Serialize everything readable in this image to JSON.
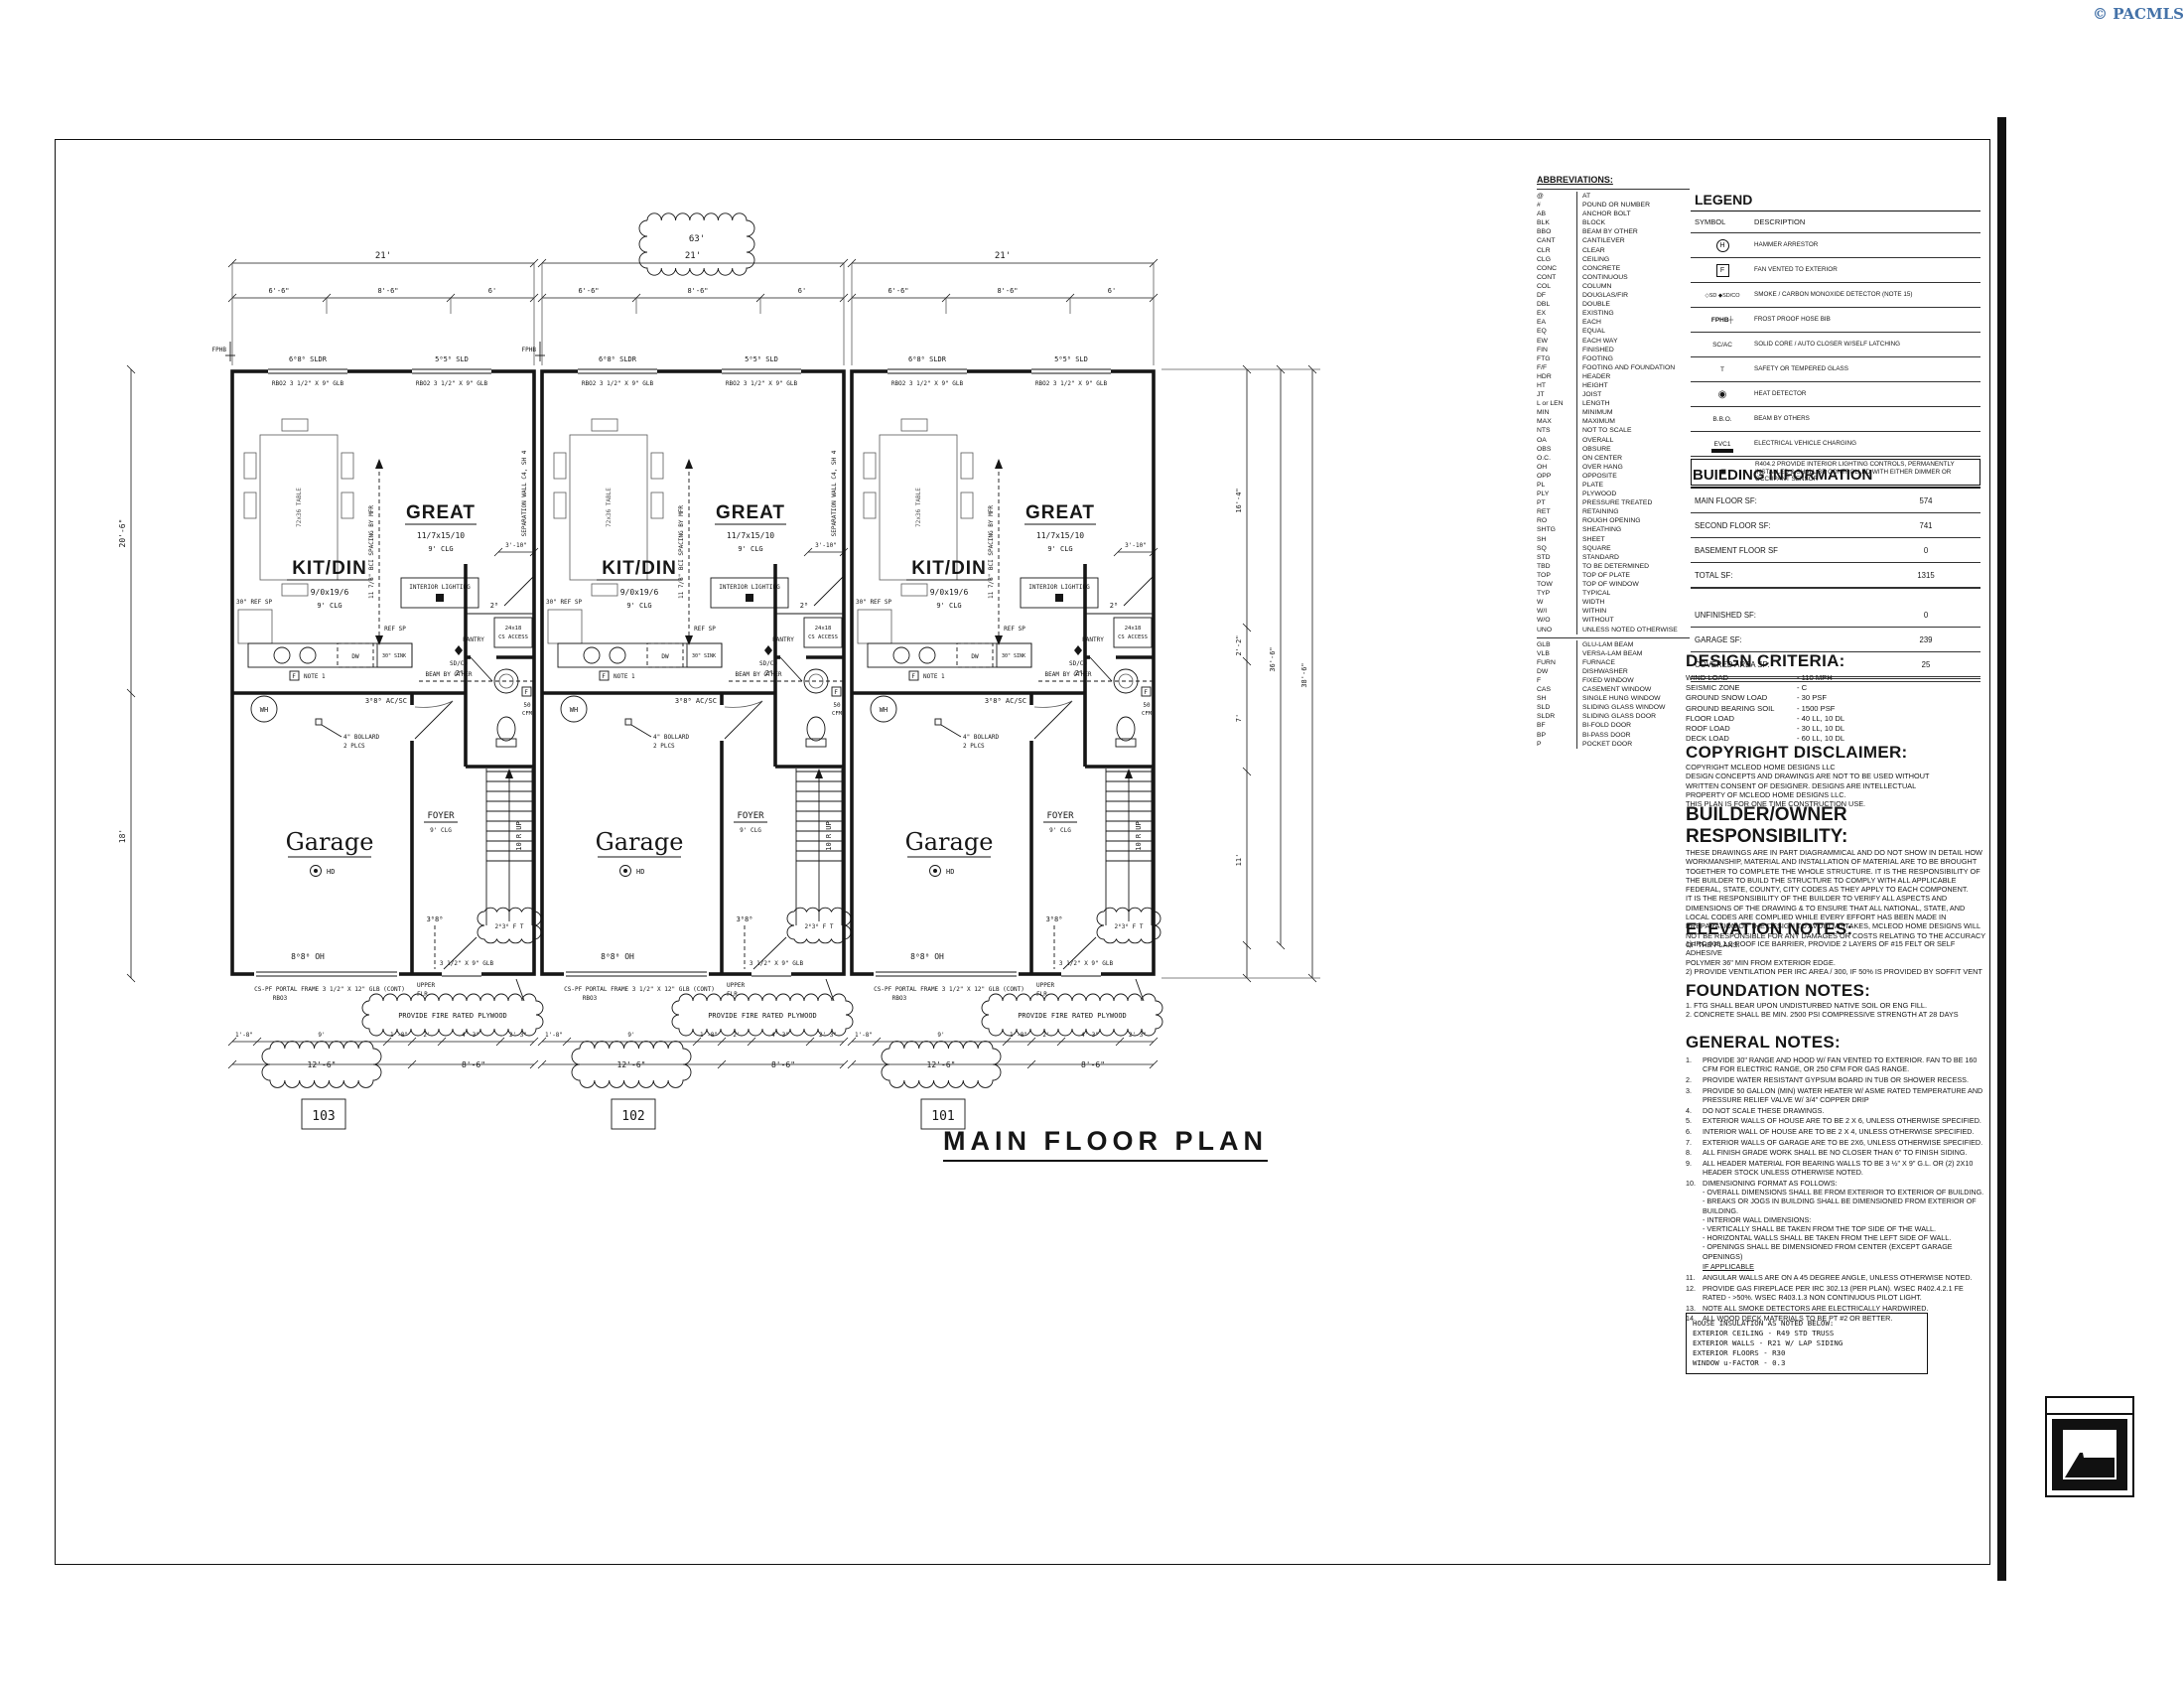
{
  "page": {
    "copyright": "© PACMLS",
    "title": "MAIN FLOOR PLAN"
  },
  "abbreviations": {
    "title": "ABBREVIATIONS:",
    "group1": [
      {
        "a": "@",
        "m": "AT"
      },
      {
        "a": "#",
        "m": "POUND OR NUMBER"
      },
      {
        "a": "AB",
        "m": "ANCHOR BOLT"
      },
      {
        "a": "BLK",
        "m": "BLOCK"
      },
      {
        "a": "BBO",
        "m": "BEAM BY OTHER"
      },
      {
        "a": "CANT",
        "m": "CANTILEVER"
      },
      {
        "a": "CLR",
        "m": "CLEAR"
      },
      {
        "a": "CLG",
        "m": "CEILING"
      },
      {
        "a": "CONC",
        "m": "CONCRETE"
      },
      {
        "a": "CONT",
        "m": "CONTINUOUS"
      },
      {
        "a": "COL",
        "m": "COLUMN"
      },
      {
        "a": "DF",
        "m": "DOUGLAS/FIR"
      },
      {
        "a": "DBL",
        "m": "DOUBLE"
      },
      {
        "a": "EX",
        "m": "EXISTING"
      },
      {
        "a": "EA",
        "m": "EACH"
      },
      {
        "a": "EQ",
        "m": "EQUAL"
      },
      {
        "a": "EW",
        "m": "EACH WAY"
      },
      {
        "a": "FIN",
        "m": "FINISHED"
      },
      {
        "a": "FTG",
        "m": "FOOTING"
      },
      {
        "a": "F/F",
        "m": "FOOTING AND FOUNDATION"
      },
      {
        "a": "HDR",
        "m": "HEADER"
      },
      {
        "a": "HT",
        "m": "HEIGHT"
      },
      {
        "a": "JT",
        "m": "JOIST"
      },
      {
        "a": "L or LEN",
        "m": "LENGTH"
      },
      {
        "a": "MIN",
        "m": "MINIMUM"
      },
      {
        "a": "MAX",
        "m": "MAXIMUM"
      },
      {
        "a": "NTS",
        "m": "NOT TO SCALE"
      },
      {
        "a": "OA",
        "m": "OVERALL"
      },
      {
        "a": "OBS",
        "m": "OBSURE"
      },
      {
        "a": "O.C.",
        "m": "ON CENTER"
      },
      {
        "a": "OH",
        "m": "OVER HANG"
      },
      {
        "a": "OPP",
        "m": "OPPOSITE"
      },
      {
        "a": "PL",
        "m": "PLATE"
      },
      {
        "a": "PLY",
        "m": "PLYWOOD"
      },
      {
        "a": "PT",
        "m": "PRESSURE TREATED"
      },
      {
        "a": "RET",
        "m": "RETAINING"
      },
      {
        "a": "RO",
        "m": "ROUGH OPENING"
      },
      {
        "a": "SHTG",
        "m": "SHEATHING"
      },
      {
        "a": "SH",
        "m": "SHEET"
      },
      {
        "a": "SQ",
        "m": "SQUARE"
      },
      {
        "a": "STD",
        "m": "STANDARD"
      },
      {
        "a": "TBD",
        "m": "TO BE DETERMINED"
      },
      {
        "a": "TOP",
        "m": "TOP OF PLATE"
      },
      {
        "a": "TOW",
        "m": "TOP OF WINDOW"
      },
      {
        "a": "TYP",
        "m": "TYPICAL"
      },
      {
        "a": "W",
        "m": "WIDTH"
      },
      {
        "a": "W/I",
        "m": "WITHIN"
      },
      {
        "a": "W/O",
        "m": "WITHOUT"
      },
      {
        "a": "UNO",
        "m": "UNLESS NOTED OTHERWISE"
      }
    ],
    "group2": [
      {
        "a": "GLB",
        "m": "GLU-LAM BEAM"
      },
      {
        "a": "VLB",
        "m": "VERSA-LAM BEAM"
      },
      {
        "a": "FURN",
        "m": "FURNACE"
      },
      {
        "a": "DW",
        "m": "DISHWASHER"
      },
      {
        "a": "F",
        "m": "FIXED WINDOW"
      },
      {
        "a": "CAS",
        "m": "CASEMENT WINDOW"
      },
      {
        "a": "SH",
        "m": "SINGLE HUNG WINDOW"
      },
      {
        "a": "SLD",
        "m": "SLIDING GLASS WINDOW"
      },
      {
        "a": "SLDR",
        "m": "SLIDING GLASS DOOR"
      },
      {
        "a": "BF",
        "m": "BI-FOLD DOOR"
      },
      {
        "a": "BP",
        "m": "BI-PASS DOOR"
      },
      {
        "a": "P",
        "m": "POCKET DOOR"
      }
    ]
  },
  "legend": {
    "title": "LEGEND",
    "symbol_header": "SYMBOL",
    "description_header": "DESCRIPTION",
    "rows": [
      {
        "sym": "H",
        "kind": "k-circle",
        "rowclass": "",
        "desc": "HAMMER ARRESTOR"
      },
      {
        "sym": "F",
        "kind": "k-box",
        "rowclass": "",
        "desc": "FAN VENTED TO EXTERIOR"
      },
      {
        "sym": "◇SD  ◆SD/CO",
        "kind": "k-detect",
        "rowclass": "",
        "desc": "SMOKE / CARBON MONOXIDE DETECTOR (NOTE 15)"
      },
      {
        "sym": "FPHB┼",
        "kind": "k-fphb",
        "rowclass": "",
        "desc": "FROST PROOF HOSE BIB"
      },
      {
        "sym": "SC/AC",
        "kind": "k-text",
        "rowclass": "",
        "desc": "SOLID CORE / AUTO CLOSER W/SELF LATCHING"
      },
      {
        "sym": "T",
        "kind": "k-text",
        "rowclass": "",
        "desc": "SAFETY OR TEMPERED GLASS"
      },
      {
        "sym": "◉",
        "kind": "k-heat",
        "rowclass": "",
        "desc": "HEAT DETECTOR"
      },
      {
        "sym": "B.B.O.",
        "kind": "k-text",
        "rowclass": "",
        "desc": "BEAM BY OTHERS"
      },
      {
        "sym": "EVC1",
        "kind": "k-evc",
        "rowclass": "",
        "desc": "ELECTRICAL  VEHICLE  CHARGING"
      },
      {
        "sym": "■",
        "kind": "k-square",
        "rowclass": "boxed",
        "desc": "R404.2 PROVIDE INTERIOR LIGHTING CONTROLS, PERMANENTLY INSTALLED & SHALL BE CONTROLLED WITH EITHER DIMMER OR OCCUPANT SENSOR"
      }
    ]
  },
  "building_information": {
    "title": "BUILDING INFORMATION",
    "rows1": [
      {
        "label": "MAIN FLOOR SF:",
        "val": "574"
      },
      {
        "label": "SECOND FLOOR SF:",
        "val": "741"
      },
      {
        "label": "BASEMENT FLOOR SF",
        "val": "0"
      },
      {
        "label": "TOTAL SF:",
        "val": "1315"
      }
    ],
    "rows2": [
      {
        "label": "UNFINISHED SF:",
        "val": "0"
      },
      {
        "label": "GARAGE SF:",
        "val": "239"
      },
      {
        "label": "COVERED AREA SF:",
        "val": "25"
      }
    ]
  },
  "design_criteria": {
    "title": "DESIGN CRITERIA:",
    "rows": [
      {
        "l": "WIND LOAD",
        "v": "- 110 MPH"
      },
      {
        "l": "SEISMIC ZONE",
        "v": "- C"
      },
      {
        "l": "GROUND SNOW LOAD",
        "v": "- 30 PSF"
      },
      {
        "l": "GROUND BEARING SOIL",
        "v": "- 1500 PSF"
      },
      {
        "l": "FLOOR LOAD",
        "v": "- 40 LL, 10 DL"
      },
      {
        "l": "ROOF LOAD",
        "v": "- 30 LL, 10 DL"
      },
      {
        "l": "DECK LOAD",
        "v": "- 60 LL, 10 DL"
      }
    ]
  },
  "copyright_disclaimer": {
    "title": "COPYRIGHT DISCLAIMER:",
    "text": "COPYRIGHT MCLEOD HOME DESIGNS LLC\nDESIGN CONCEPTS AND DRAWINGS ARE NOT TO BE USED WITHOUT\nWRITTEN CONSENT OF DESIGNER. DESIGNS ARE INTELLECTUAL\nPROPERTY OF MCLEOD HOME DESIGNS LLC.\nTHIS PLAN IS FOR ONE TIME CONSTRUCTION USE."
  },
  "builder_owner": {
    "title": "BUILDER/OWNER RESPONSIBILITY:",
    "text": "THESE DRAWINGS ARE IN PART DIAGRAMMICAL AND DO NOT SHOW IN DETAIL HOW WORKMANSHIP, MATERIAL AND INSTALLATION OF MATERIAL ARE TO BE BROUGHT TOGETHER TO COMPLETE THE WHOLE STRUCTURE.  IT IS THE RESPONSIBILITY OF THE BUILDER TO BUILD THE STRUCTURE TO COMPLY WITH ALL APPLICABLE FEDERAL, STATE, COUNTY, CITY CODES AS THEY APPLY TO EACH COMPONENT.\nIT IS THE RESPONSIBILITY OF THE BUILDER TO VERIFY ALL ASPECTS AND DIMENSIONS OF THE DRAWING & TO ENSURE THAT ALL NATIONAL, STATE, AND LOCAL CODES ARE COMPLIED WHILE EVERY EFFORT HAS BEEN MADE IN PREPARATION OF THE DESIGN TO AVOID MISTAKES, MCLEOD HOME DESIGNS WILL NOT BE RESPONSIBLE FOR ANY DAMAGES OR COSTS RELATING TO THE ACCURACY OF THE PLANS."
  },
  "elevation_notes": {
    "title": "ELEVATION NOTES:",
    "text": "1)    IRC 905.1.2 ROOF ICE BARRIER, PROVIDE 2 LAYERS OF #15 FELT OR SELF ADHESIVE\nPOLYMER 36\" MIN FROM EXTERIOR EDGE.\n2)    PROVIDE VENTILATION PER IRC AREA / 300, IF 50% IS PROVIDED BY SOFFIT VENT"
  },
  "foundation_notes": {
    "title": "FOUNDATION NOTES:",
    "text": "1.    FTG SHALL BEAR UPON UNDISTURBED NATIVE SOIL OR ENG FILL.\n2.    CONCRETE SHALL BE MIN. 2500 PSI COMPRESSIVE STRENGTH AT 28 DAYS"
  },
  "general_notes": {
    "title": "GENERAL NOTES:",
    "items": [
      {
        "n": "1.",
        "t": "PROVIDE 30\" RANGE AND HOOD W/ FAN VENTED TO EXTERIOR.  FAN TO BE 160 CFM FOR ELECTRIC RANGE, OR 250 CFM FOR GAS RANGE.",
        "c": ""
      },
      {
        "n": "2.",
        "t": "PROVIDE WATER RESISTANT GYPSUM BOARD IN TUB OR SHOWER RECESS.",
        "c": ""
      },
      {
        "n": "3.",
        "t": "PROVIDE 50 GALLON (MIN) WATER HEATER W/ ASME RATED TEMPERATURE AND PRESSURE  RELIEF VALVE W/ 3/4\" COPPER DRIP",
        "c": ""
      },
      {
        "n": "4.",
        "t": "DO NOT SCALE THESE DRAWINGS.",
        "c": ""
      },
      {
        "n": "5.",
        "t": "EXTERIOR WALLS OF HOUSE ARE TO BE 2 X 6, UNLESS OTHERWISE SPECIFIED.",
        "c": ""
      },
      {
        "n": "6.",
        "t": "INTERIOR WALL OF HOUSE ARE TO BE  2 X 4, UNLESS OTHERWISE SPECIFIED.",
        "c": ""
      },
      {
        "n": "7.",
        "t": "EXTERIOR WALLS OF GARAGE ARE TO BE 2X6, UNLESS OTHERWISE SPECIFIED.",
        "c": ""
      },
      {
        "n": "8.",
        "t": "ALL FINISH GRADE WORK SHALL BE NO CLOSER THAN 6\" TO FINISH SIDING.",
        "c": ""
      },
      {
        "n": "9.",
        "t": "ALL HEADER MATERIAL FOR BEARING WALLS TO BE 3 ½\" X 9\" G.L. OR (2) 2X10 HEADER STOCK UNLESS OTHERWISE NOTED.",
        "c": ""
      },
      {
        "n": "10.",
        "t": "DIMENSIONING FORMAT AS FOLLOWS:\n-  OVERALL DIMENSIONS SHALL BE FROM EXTERIOR TO EXTERIOR OF BUILDING.\n-  BREAKS OR JOGS IN BUILDING SHALL BE DIMENSIONED FROM EXTERIOR OF BUILDING.\n-  INTERIOR WALL DIMENSIONS:\n-  VERTICALLY SHALL BE TAKEN FROM THE TOP SIDE OF THE WALL.\n-  HORIZONTAL WALLS SHALL BE TAKEN FROM THE LEFT SIDE OF WALL.\n-  OPENINGS SHALL BE DIMENSIONED FROM CENTER (EXCEPT GARAGE OPENINGS)",
        "c": ""
      },
      {
        "n": "",
        "t": "IF APPLICABLE",
        "c": "u-line"
      },
      {
        "n": "11.",
        "t": "ANGULAR WALLS ARE ON A 45 DEGREE ANGLE, UNLESS OTHERWISE NOTED.",
        "c": ""
      },
      {
        "n": "12.",
        "t": "PROVIDE GAS FIREPLACE PER IRC 302.13 (PER PLAN).  WSEC R402.4.2.1 FE RATED - >50%.  WSEC R403.1.3 NON CONTINUOUS PILOT LIGHT.",
        "c": ""
      },
      {
        "n": "13.",
        "t": "NOTE ALL SMOKE DETECTORS ARE ELECTRICALLY HARDWIRED.",
        "c": ""
      },
      {
        "n": "14.",
        "t": "ALL WOOD DECK MATERIALS TO BE PT #2 OR BETTER.",
        "c": ""
      }
    ]
  },
  "insulation": {
    "lines": [
      "HOUSE INSULATION AS NOTED BELOW:",
      "EXTERIOR CEILING    -  R49 STD TRUSS",
      "EXTERIOR WALLS      -  R21 W/ LAP SIDING",
      "EXTERIOR FLOORS    -  R30",
      "WINDOW u-FACTOR  -  0.3"
    ]
  },
  "plan": {
    "units": [
      {
        "number": "103"
      },
      {
        "number": "102"
      },
      {
        "number": "101"
      }
    ],
    "unit_labels": {
      "win1": "6⁰8⁰ SLDR",
      "win2": "5⁰5⁰ SLD",
      "hdr": "RBO2 3 1/2\" X 9\" GLB",
      "great": "GREAT",
      "great_dim": "11/7x15/10",
      "clg9": "9' CLG",
      "kitdin": "KIT/DIN",
      "kitdin_dim": "9/0x19/6",
      "table": "72x36 TABLE",
      "bci": "11 7/8\" BCI SPACING BY MFR",
      "sep": "SEPARATION WALL C4, SH 4",
      "ref": "30\" REF SP",
      "refsp": "REF SP",
      "dw": "DW",
      "sink": "30\" SINK",
      "fletter": "F",
      "fnote": "NOTE 1",
      "il": "INTERIOR LIGHTING",
      "pantry": "PANTRY",
      "sdco": "SD/CO",
      "beam": "BEAM BY OTHER",
      "cs1": "24x18",
      "cs2": "CS ACCESS",
      "d28": "2⁸",
      "dim310": "3'-10\"",
      "wh": "WH",
      "bol1": "4\" BOLLARD",
      "bol2": "2 PLCS",
      "garage": "Garage",
      "hd": "HD",
      "acsc": "3⁰8⁸ AC/SC",
      "d20": "2⁰",
      "f50": "50",
      "cfm": "CFM",
      "foyer": "FOYER",
      "stairs": "10 R UP",
      "d38": "3⁰8⁸",
      "w2636": "2⁶3⁶ F T",
      "glb9": "3 1/2\" X 9\" GLB",
      "oh": "8⁰8⁰ OH",
      "portal": "CS-PF PORTAL FRAME 3 1/2\" X 12\" GLB (CONT)",
      "rbo3": "RBO3",
      "upper1": "UPPER",
      "upper2": "FLR",
      "fire": "PROVIDE FIRE RATED PLYWOOD",
      "fphb": "FPHB"
    },
    "dims": {
      "u21": "21'",
      "total63": "63'",
      "sub": [
        "6'-6\"",
        "8'-6\"",
        "6'"
      ],
      "left": [
        "20'-6\"",
        "18'"
      ],
      "right": [
        "16'-4\"",
        "2'-2\"",
        "7'",
        "11'"
      ],
      "rtot": [
        "36'-6\"",
        "38'-6\""
      ],
      "b1": [
        "1'-8\"",
        "9'",
        "1'-8\"",
        "2'",
        "4'-3\"",
        "2'-3\""
      ],
      "b2": [
        "12'-6\"",
        "8'-6\""
      ]
    }
  }
}
